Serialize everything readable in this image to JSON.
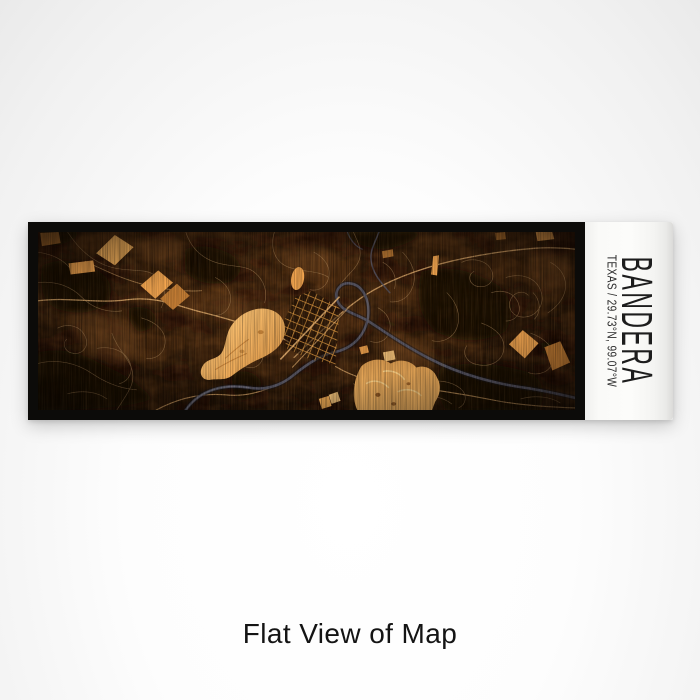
{
  "product": {
    "label": {
      "title": "BANDERA",
      "subtitle": "TEXAS / 29.73°N, 99.07°W"
    },
    "caption": "Flat View of Map"
  },
  "colors": {
    "frame": "#0c0b09",
    "panel": "#fafaf8",
    "labelText": "#1d1d1d",
    "caption": "#141414",
    "mapBaseTop": "#48290f",
    "mapBaseBottom": "#2c1808",
    "ink": "#120a04",
    "mottleLight": "#7a4c22",
    "parcel": "#f3a54f",
    "parcelLight": "#f9c87d",
    "parcelDim": "#c77f35",
    "road": "#b99263",
    "roadMajor": "#e5b070",
    "water": "#565666",
    "waterDark": "#16161e",
    "gridStreet": "#db963f"
  }
}
